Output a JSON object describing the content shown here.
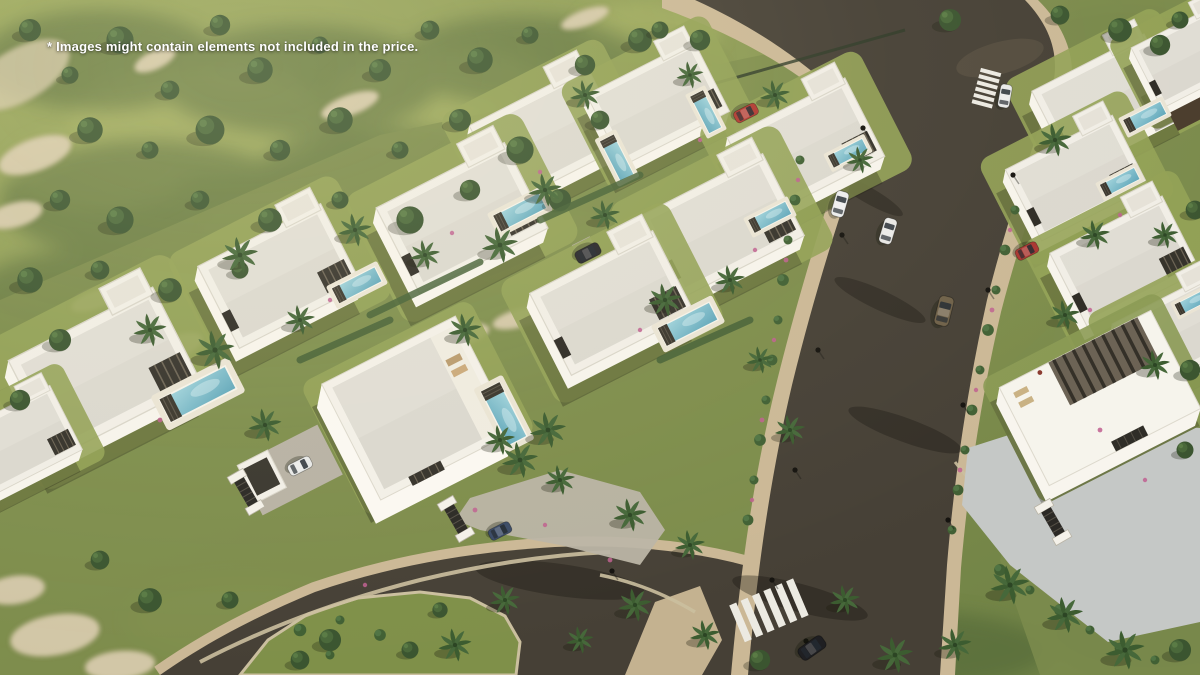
{
  "watermark": {
    "text": "* Images might contain elements not included in the price."
  },
  "scene": {
    "subject": "Aerial 3D render of a gated luxury villa development with private pools, landscaped gardens, a curved cul-de-sac road and a main street with zebra crossings",
    "palette": {
      "grass_base": "#8a9852",
      "grass_shade": "#4c6234",
      "grass_sun": "#a8b264",
      "road_asphalt": "#464036",
      "road_patch": "#564e40",
      "sidewalk": "#cbb896",
      "curb_stone": "#cbbf9f",
      "island_green": "#7f9049",
      "forecourt": "#c5c8c6",
      "villa_wall": "#f4f1e9",
      "villa_roof": "#dbd8cf",
      "pergola": "#35322b",
      "pool_water": "#8fc4d2",
      "pool_deck": "#eae4d4",
      "crosswalk": "#eceae2",
      "tree_canopy": "#3b5530",
      "palm_frond": "#3c5c30",
      "flower_accent": "#c06090"
    }
  }
}
